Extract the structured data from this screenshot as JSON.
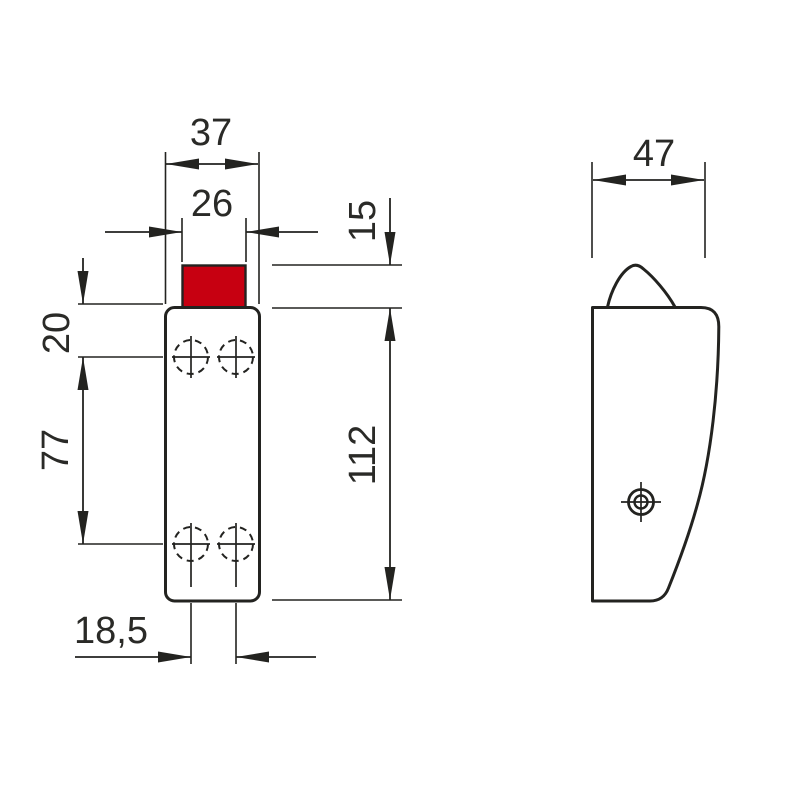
{
  "drawing": {
    "kind": "technical-dimension-drawing",
    "line_color": "#232320",
    "accent_red": "#c70011",
    "dimensions": {
      "d37": {
        "label": "37"
      },
      "d26": {
        "label": "26"
      },
      "d15": {
        "label": "15"
      },
      "d20": {
        "label": "20"
      },
      "d77": {
        "label": "77"
      },
      "d112": {
        "label": "112"
      },
      "d18_5": {
        "label": "18,5"
      },
      "d47": {
        "label": "47"
      }
    }
  }
}
